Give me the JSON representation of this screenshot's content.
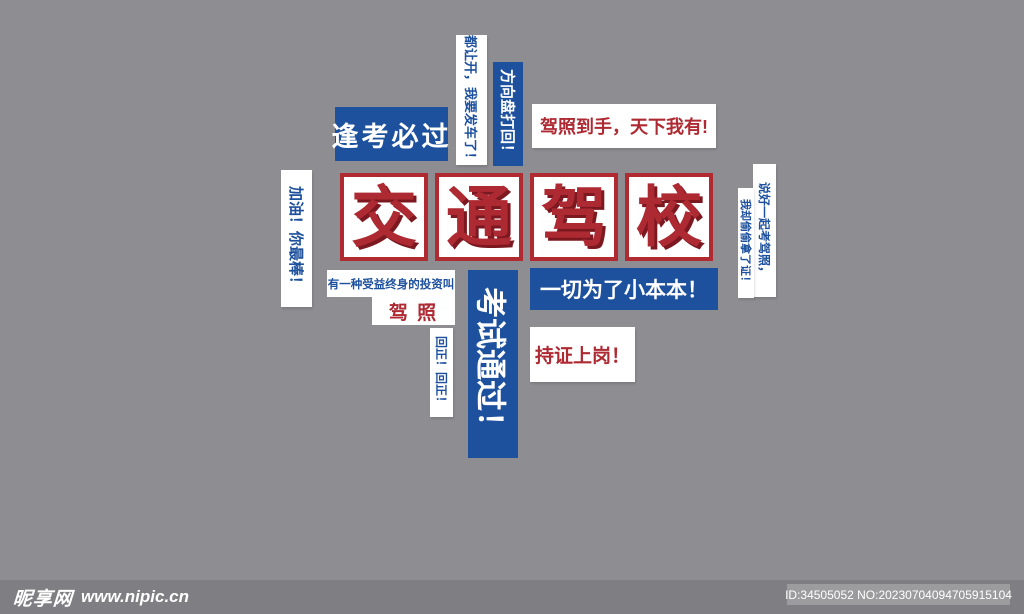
{
  "poster": {
    "title": {
      "characters": [
        "交",
        "通",
        "驾",
        "校"
      ]
    },
    "slogans": {
      "fengkao": "逢考必过",
      "dourangkai": "都让开，我要发车了！",
      "fangxiangpan": "方向盘打回！",
      "jiazhaodaoshou": "驾照到手，天下我有!",
      "jiayou": "加油！你最棒！",
      "touzi_line1": "有一种受益终身的投资叫",
      "touzi_line2": "驾 照",
      "huizheng": "回正！回正！",
      "kaoshi": "考试通过！",
      "yiqie": "一切为了小本本！",
      "chizheng": "持证上岗！",
      "shuohao": "说好一起考驾照，",
      "woque": "我却偷偷拿了证！"
    },
    "colors": {
      "background": "#8e8e92",
      "blue": "#1d509d",
      "red": "#ae2a32",
      "red_shadow": "#7c1820",
      "footer_bar": "#7f7f83",
      "badge": "#9c9c9f"
    }
  },
  "footer": {
    "site_name": "昵享网",
    "site_url": "www.nipic.cn",
    "id_text": "ID:34505052 NO:20230704094705915104"
  }
}
